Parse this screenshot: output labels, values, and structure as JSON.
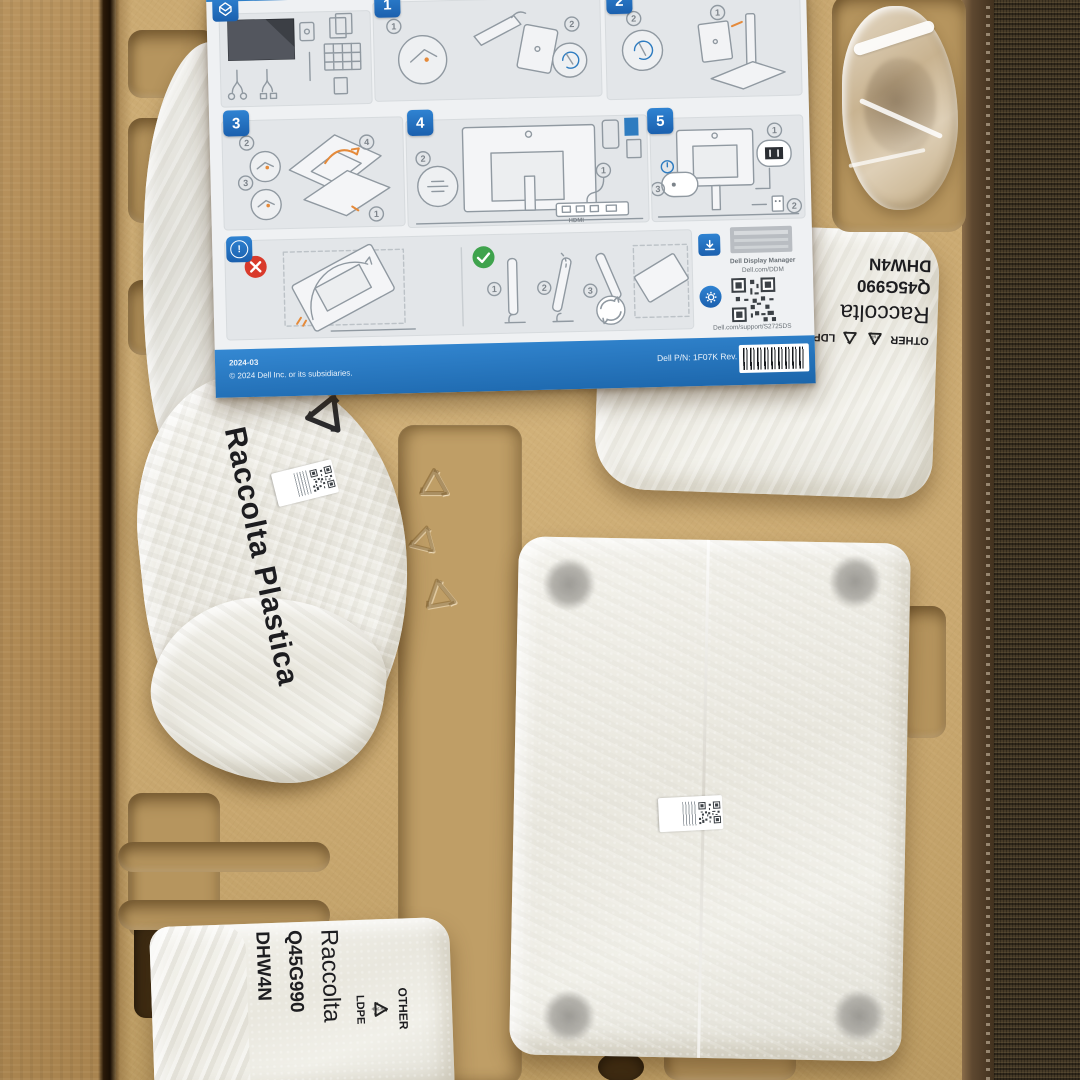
{
  "subject": "Opened Dell monitor shipping box: molded pulp tray with quick setup sheet and white-wrapped parts",
  "colors": {
    "pulp_tray": "#c9a870",
    "cardboard_flap": "#b08a55",
    "carpet": "#463a27",
    "dell_blue": "#1f6fc0",
    "sheet_bg": "#eff1f3",
    "bag_white": "#efeee6"
  },
  "sheet": {
    "panels": {
      "p1": {
        "number": "1",
        "callouts": [
          "1",
          "2"
        ]
      },
      "p2": {
        "number": "2",
        "callouts": [
          "1",
          "2"
        ]
      },
      "p3": {
        "number": "3",
        "callouts": [
          "1",
          "2",
          "3",
          "4"
        ]
      },
      "p4": {
        "number": "4",
        "callouts": [
          "1",
          "2"
        ],
        "port_label": "HDMI"
      },
      "p5": {
        "number": "5",
        "callouts": [
          "1",
          "2",
          "3"
        ]
      },
      "caution": {
        "steps": [
          "1",
          "2",
          "3"
        ]
      }
    },
    "downloads": {
      "ddm_title": "Dell Display Manager",
      "ddm_url": "Dell.com/DDM",
      "support_url": "Dell.com/support/S2725DS"
    },
    "footer": {
      "date": "2024-03",
      "copyright": "© 2024 Dell Inc. or its subsidiaries.",
      "part": "Dell P/N: 1F07K Rev. A00"
    }
  },
  "bags": {
    "left": {
      "label": "Raccolta Plastica"
    },
    "top_right": {
      "code": "DHW4N",
      "part": "Q45G990",
      "label": "Raccolta",
      "material_a": "OTHER",
      "material_b": "LDPE",
      "korean": "비닐류"
    },
    "bottom_left": {
      "code": "DHW4N",
      "part": "Q45G990",
      "label": "Raccolta",
      "material_a": "OTHER",
      "material_b": "LDPE",
      "korean": "비닐류"
    }
  },
  "tray": {
    "embossed_code": "LDB0U1BX"
  }
}
